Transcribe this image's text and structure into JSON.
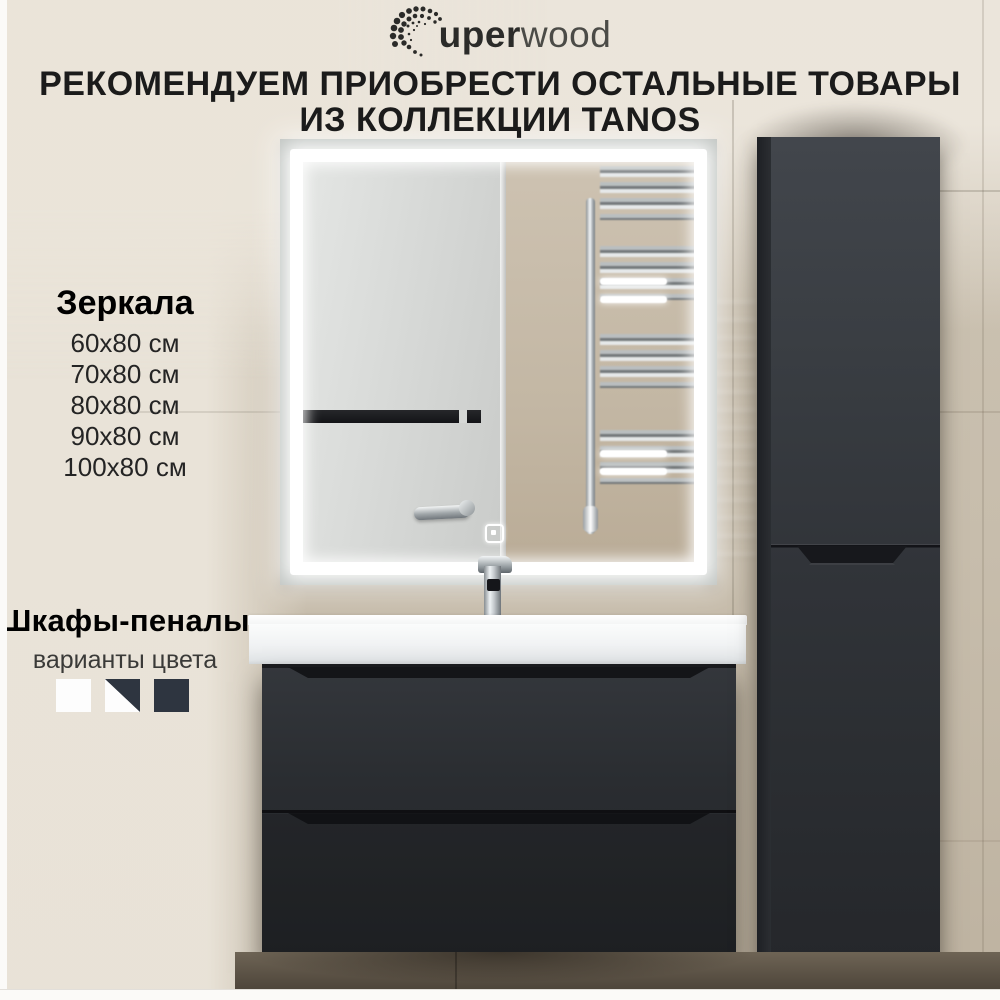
{
  "brand": {
    "logo_bold": "uper",
    "logo_light": "wood"
  },
  "heading": {
    "line1": "РЕКОМЕНДУЕМ ПРИОБРЕСТИ ОСТАЛЬНЫЕ ТОВАРЫ",
    "line2": "ИЗ КОЛЛЕКЦИИ TANOS"
  },
  "mirrors": {
    "title": "Зеркала",
    "sizes": [
      "60x80 см",
      "70x80 см",
      "80x80 см",
      "90x80 см",
      "100x80 см"
    ]
  },
  "pencil_cabinets": {
    "title": "Шкафы-пеналы",
    "subtitle": "варианты цвета",
    "swatches": [
      {
        "name": "white",
        "hex": "#fdfdfd"
      },
      {
        "name": "white-graphite",
        "hex": "#fdfdfd / #2e3540"
      },
      {
        "name": "graphite",
        "hex": "#2e3540"
      }
    ]
  },
  "colors": {
    "text": "#1b1b1b",
    "wall_beige": "#c7bdac",
    "panel_light": "#e9e3d8",
    "furniture_dark": "#2b2e32",
    "led_white": "#ffffff"
  }
}
